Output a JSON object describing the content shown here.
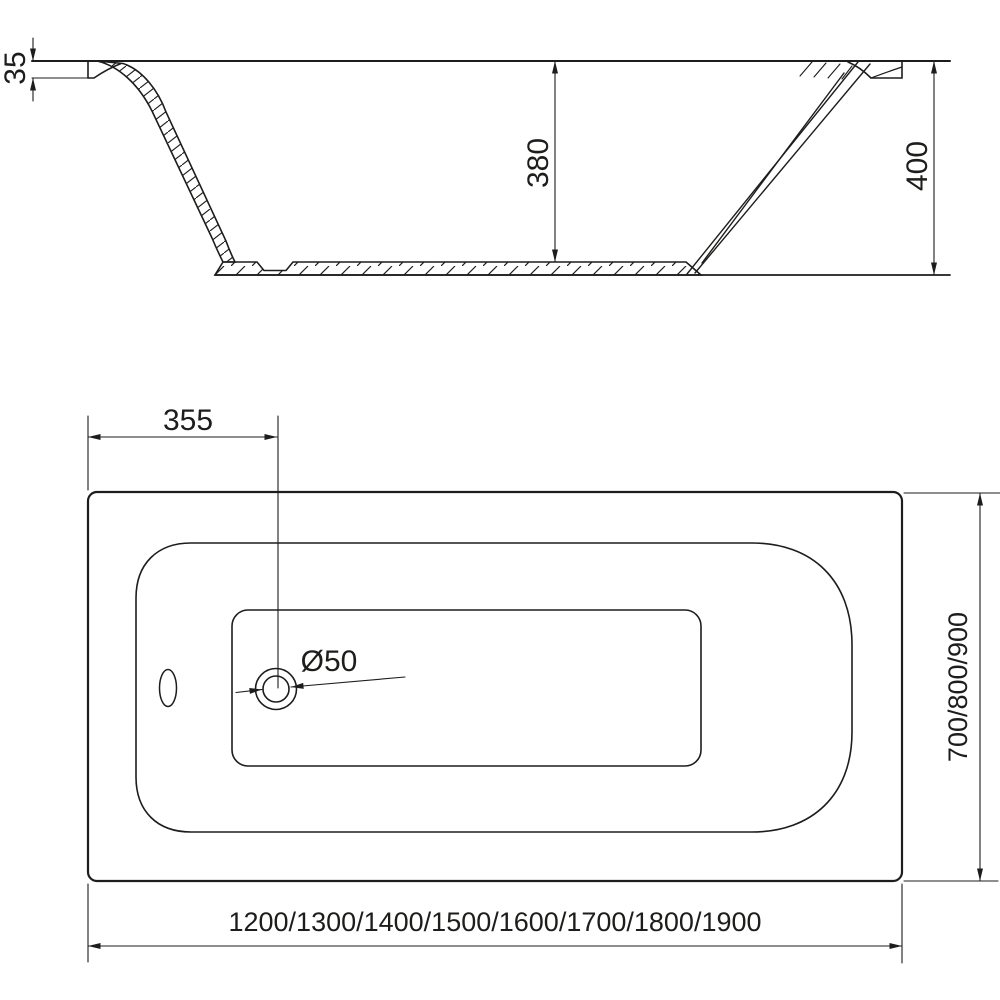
{
  "drawing": {
    "type": "bathtub-technical-drawing",
    "views": {
      "section_view_name": "side cross-section",
      "top_view_name": "top view"
    }
  },
  "section_view": {
    "dim_rim_thickness": "35",
    "dim_inner_depth": "380",
    "dim_total_height": "400"
  },
  "top_view": {
    "dim_drain_offset": "355",
    "dim_drain_diameter": "Ø50",
    "dim_width_options": "700/800/900",
    "dim_length_options": "1200/1300/1400/1500/1600/1700/1800/1900"
  },
  "colors": {
    "line": "#1d1d1b",
    "background": "#ffffff"
  }
}
